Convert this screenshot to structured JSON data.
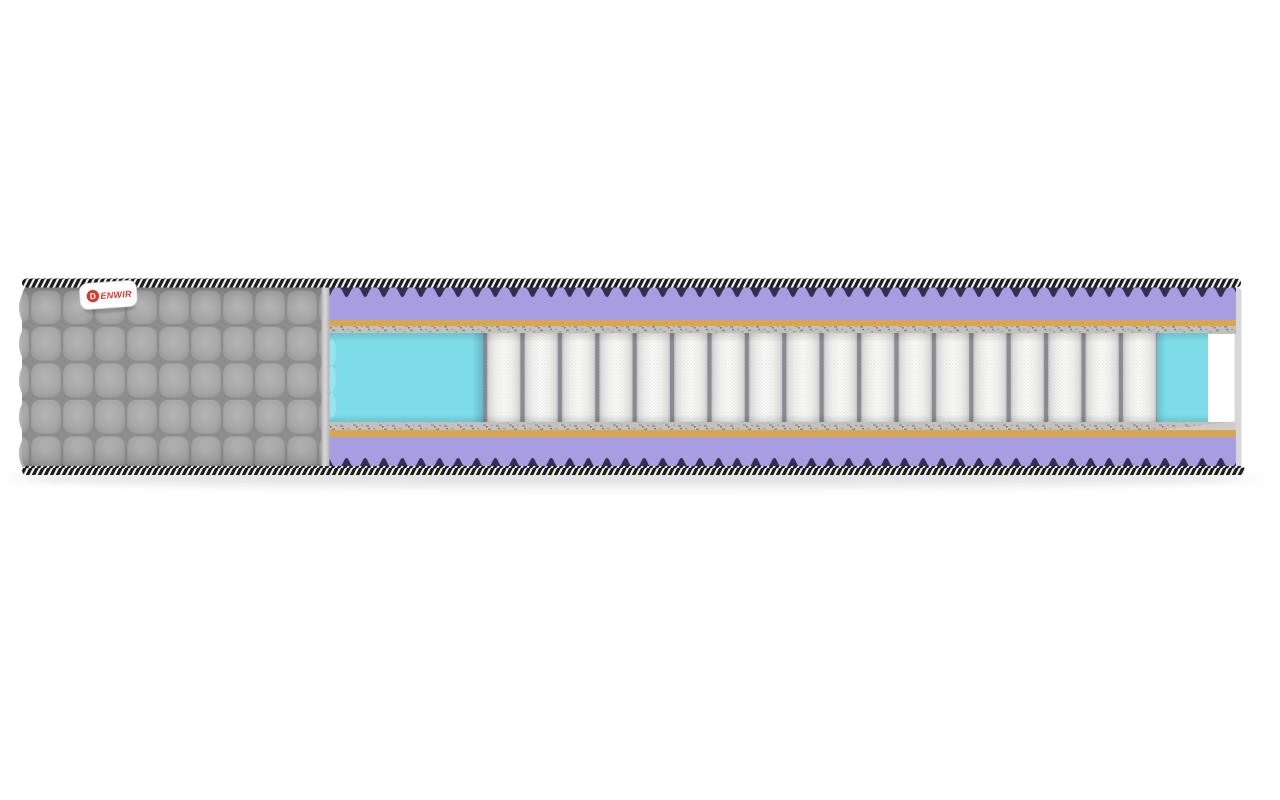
{
  "meta": {
    "description": "Cross-section product render of a pocket-spring mattress with a gray quilted cover, purple wave comfort foam layers, tan pads, felt layers, cyan edge-support foam and white fabric-pocketed springs on a white background",
    "background_color": "#ffffff"
  },
  "brand_tag": {
    "brand_name": "DENWIR",
    "logo_letter": "D",
    "wordmark": "ENWIR"
  },
  "construction": {
    "visible_spring_count": 18,
    "quilt_rows": 5
  },
  "colors": {
    "background": "#ffffff",
    "cover-gray": "#a2a2a2",
    "cover-crease": "#8d8d8d",
    "cover-cut-edge": "#cccccc",
    "piping-dark": "#1c1c1c",
    "piping-light": "#f2f2f2",
    "foam-purple": "#a89de1",
    "wave-shadow": "#332f50",
    "pad-tan": "#d7a64f",
    "felt-gray": "#c2c1be",
    "spring-white": "#f6f6f4",
    "spring-gap": "#8a8a93",
    "foam-cyan": "#7edce9",
    "cyan-shade": "#2d6f80",
    "right-edge-gray": "#d7d7d7",
    "label-red": "#d43a2f",
    "label-white": "#ffffff"
  }
}
